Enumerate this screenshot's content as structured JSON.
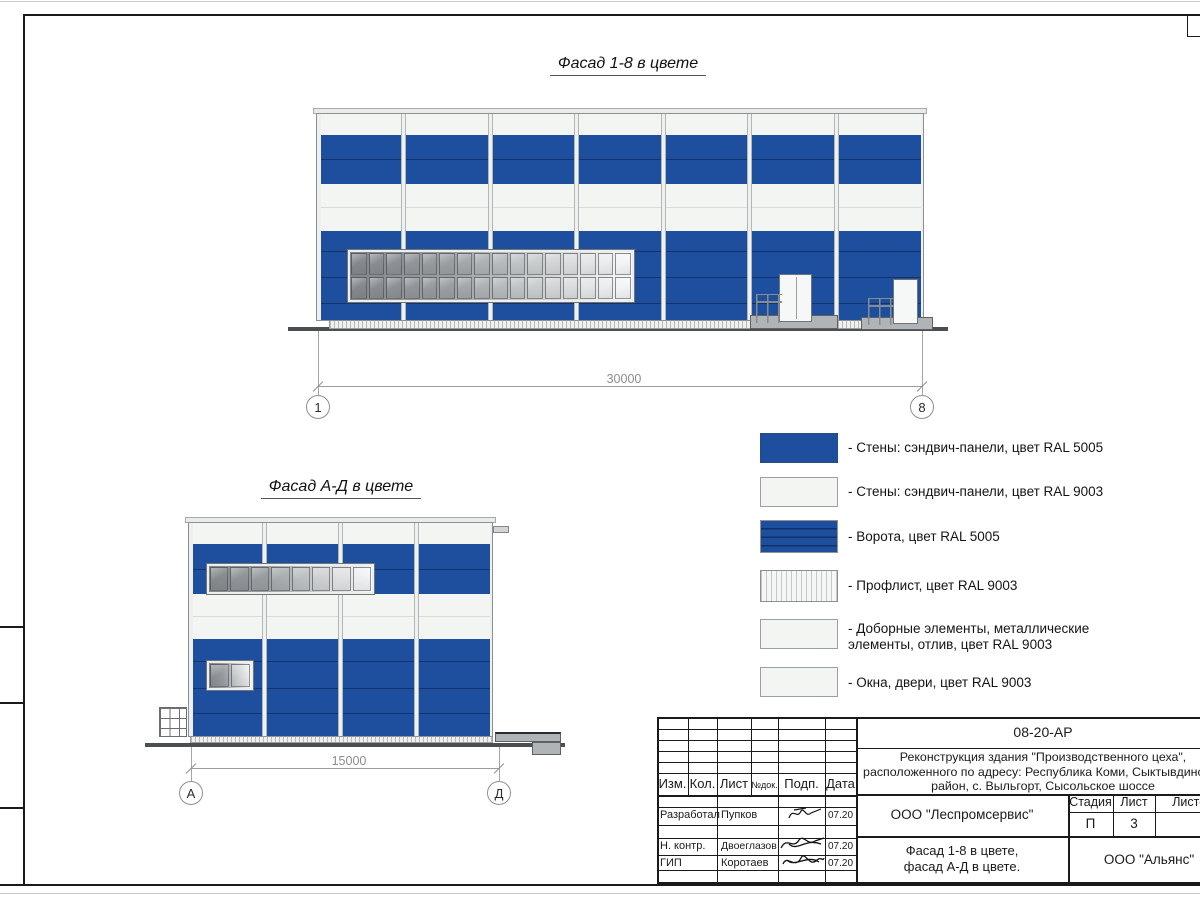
{
  "colors": {
    "ral5005": "#1d4f9e",
    "ral9003": "#f3f5f3"
  },
  "titles": {
    "facade18": "Фасад 1-8 в цвете",
    "facadeAD": "Фасад А-Д в цвете"
  },
  "facade18": {
    "dimension": "30000",
    "axis_left": "1",
    "axis_right": "8",
    "bays": 7,
    "window": {
      "cols": 16,
      "rows": 2
    }
  },
  "facadeAD": {
    "dimension": "15000",
    "axis_left": "А",
    "axis_right": "Д",
    "bays": 4,
    "window": {
      "cols": 8,
      "rows": 1
    },
    "small_window": {
      "cols": 2,
      "rows": 1
    }
  },
  "legend": {
    "items": [
      {
        "swatch": "blue-solid",
        "label": "- Стены: сэндвич-панели, цвет RAL 5005"
      },
      {
        "swatch": "white-solid",
        "label": "- Стены: сэндвич-панели, цвет RAL 9003"
      },
      {
        "swatch": "blue-gate",
        "label": "- Ворота, цвет RAL 5005"
      },
      {
        "swatch": "white-hatch",
        "label": "- Профлист, цвет RAL 9003"
      },
      {
        "swatch": "white-solid",
        "label": "- Доборные элементы, металлические",
        "label2": "элементы, отлив, цвет RAL 9003"
      },
      {
        "swatch": "white-solid",
        "label": "- Окна, двери, цвет RAL 9003"
      }
    ]
  },
  "titleblock": {
    "doc_number": "08-20-АР",
    "project_line1": "Реконструкция здания \"Производственного цеха\",",
    "project_line2": "расположенного по адресу: Республика Коми, Сыктывдинский",
    "project_line3": "район, с. Выльгорт, Сысольское шоссе",
    "org": "ООО \"Леспромсервис\"",
    "sheet_title_line1": "Фасад 1-8 в цвете,",
    "sheet_title_line2": "фасад А-Д в цвете.",
    "contractor": "ООО \"Альянс\"",
    "stage_label": "Стадия",
    "stage_value": "П",
    "sheet_label": "Лист",
    "sheet_value": "3",
    "sheets_label": "Листов",
    "columns": [
      "Изм.",
      "Кол.",
      "Лист",
      "№док.",
      "Подп.",
      "Дата"
    ],
    "rows": [
      {
        "role": "Разработал",
        "name": "Пупков",
        "date": "07.20"
      },
      {
        "role": "Н. контр.",
        "name": "Двоеглазов",
        "date": "07.20"
      },
      {
        "role": "ГИП",
        "name": "Коротаев",
        "date": "07.20"
      }
    ]
  }
}
